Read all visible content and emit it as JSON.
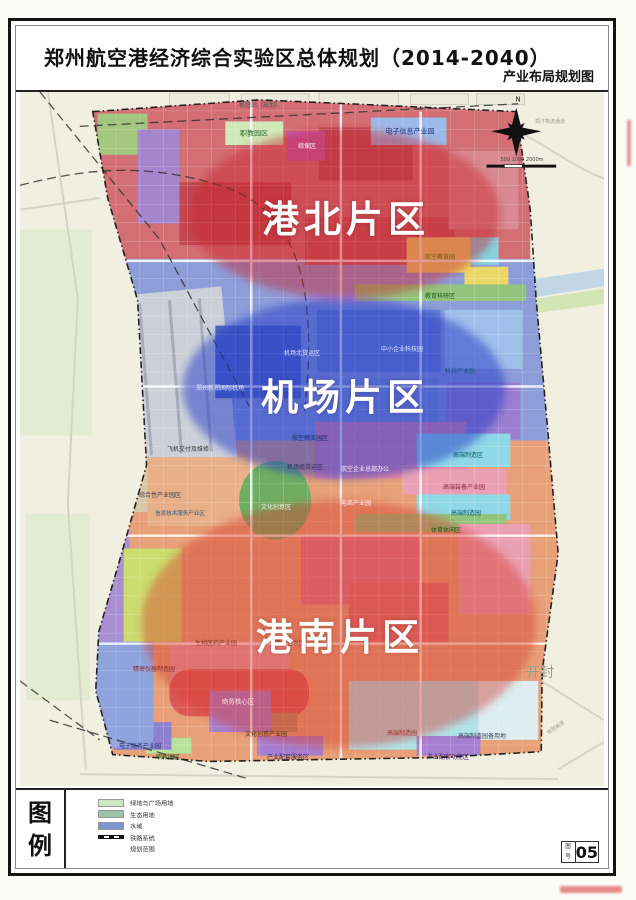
{
  "document": {
    "title": "郑州航空港经济综合实验区总体规划（2014-2040）",
    "subtitle": "产业布局规划图"
  },
  "zones": [
    {
      "label": "港北片区",
      "fill": "rgba(200,30,45,0.46)",
      "cx": 326,
      "cy": 124,
      "rx": 156,
      "ry": 86
    },
    {
      "label": "机场片区",
      "fill": "rgba(38,56,198,0.50)",
      "cx": 325,
      "cy": 302,
      "rx": 162,
      "ry": 92
    },
    {
      "label": "港南片区",
      "fill": "rgba(214,58,48,0.44)",
      "cx": 320,
      "cy": 542,
      "rx": 198,
      "ry": 126
    }
  ],
  "legend": {
    "title_chars": [
      "图",
      "例"
    ],
    "items": [
      {
        "type": "swatch",
        "color": "#cfe4c0",
        "label": "绿地与广场用地"
      },
      {
        "type": "swatch",
        "color": "#9cc4ac",
        "label": "生态用地"
      },
      {
        "type": "swatch",
        "color": "#7e96d0",
        "label": "水域"
      },
      {
        "type": "rail",
        "color": "#111111",
        "label": "铁路系统"
      },
      {
        "type": "boundary",
        "color": "#333333",
        "label": "规划范围"
      }
    ]
  },
  "sheet": {
    "label_chars": [
      "图",
      "号"
    ],
    "number": "05"
  },
  "map_labels": [
    {
      "t": "枢纽站（规划）",
      "x": 240,
      "y": 14,
      "c": "#555555",
      "s": 6
    },
    {
      "t": "职教园区",
      "x": 234,
      "y": 42,
      "c": "#2a6a2a",
      "s": 7
    },
    {
      "t": "综保区",
      "x": 287,
      "y": 55,
      "c": "#ffffff",
      "s": 6
    },
    {
      "t": "电子信息产业园",
      "x": 390,
      "y": 40,
      "c": "#16347e",
      "s": 7
    },
    {
      "t": "郑汴物流通道",
      "x": 530,
      "y": 30,
      "c": "#9a9a90",
      "s": 5
    },
    {
      "t": "N",
      "x": 498,
      "y": 8,
      "c": "#222222",
      "s": 7
    },
    {
      "t": "500 1000 2000m",
      "x": 502,
      "y": 68,
      "c": "#444444",
      "s": 5
    },
    {
      "t": "航空教育园",
      "x": 420,
      "y": 166,
      "c": "#7a5a10",
      "s": 6
    },
    {
      "t": "教育科研区",
      "x": 420,
      "y": 205,
      "c": "#1e5a1e",
      "s": 6
    },
    {
      "t": "机场北货运区",
      "x": 282,
      "y": 262,
      "c": "#dfe8ff",
      "s": 6
    },
    {
      "t": "郑州新郑国际机场",
      "x": 200,
      "y": 297,
      "c": "#e8ecff",
      "s": 6
    },
    {
      "t": "中小企业科技园",
      "x": 382,
      "y": 258,
      "c": "#dbe4ff",
      "s": 6
    },
    {
      "t": "科技产业园",
      "x": 440,
      "y": 280,
      "c": "#175a78",
      "s": 6
    },
    {
      "t": "航空物流园区",
      "x": 290,
      "y": 347,
      "c": "#1a2a6a",
      "s": 6
    },
    {
      "t": "飞机交付及维修",
      "x": 168,
      "y": 358,
      "c": "#333333",
      "s": 6
    },
    {
      "t": "机场南货运区",
      "x": 285,
      "y": 376,
      "c": "#2a3050",
      "s": 6
    },
    {
      "t": "航空企业总部办公",
      "x": 345,
      "y": 378,
      "c": "#fff2f2",
      "s": 6
    },
    {
      "t": "综合性产业园区",
      "x": 140,
      "y": 404,
      "c": "#404050",
      "s": 6
    },
    {
      "t": "信息技术服务产业区",
      "x": 160,
      "y": 422,
      "c": "#2a5a8a",
      "s": 5.5
    },
    {
      "t": "文化创意区",
      "x": 256,
      "y": 416,
      "c": "#eaffea",
      "s": 6
    },
    {
      "t": "电商产业园",
      "x": 336,
      "y": 412,
      "c": "#fff0f4",
      "s": 6
    },
    {
      "t": "高端制造区",
      "x": 448,
      "y": 364,
      "c": "#0a5a6a",
      "s": 6
    },
    {
      "t": "高端装备产业园",
      "x": 444,
      "y": 396,
      "c": "#8a2a4a",
      "s": 6
    },
    {
      "t": "高端制造园",
      "x": 446,
      "y": 422,
      "c": "#0a5a6a",
      "s": 6
    },
    {
      "t": "体育休闲区",
      "x": 426,
      "y": 439,
      "c": "#1a5a1a",
      "s": 6
    },
    {
      "t": "精密仪器制造园",
      "x": 134,
      "y": 578,
      "c": "#8a2a2a",
      "s": 6
    },
    {
      "t": "生物医药产业园",
      "x": 196,
      "y": 552,
      "c": "#8a3a2a",
      "s": 6
    },
    {
      "t": "电子信息园",
      "x": 270,
      "y": 552,
      "c": "#8a3a2a",
      "s": 6
    },
    {
      "t": "商务核心区",
      "x": 218,
      "y": 610,
      "c": "#ffe0e0",
      "s": 6.5
    },
    {
      "t": "文化创意产业园",
      "x": 246,
      "y": 643,
      "c": "#50350f",
      "s": 6
    },
    {
      "t": "电子商务产业园",
      "x": 120,
      "y": 655,
      "c": "#2a2a7a",
      "s": 6
    },
    {
      "t": "职教园区",
      "x": 148,
      "y": 666,
      "c": "#1a5a1a",
      "s": 6
    },
    {
      "t": "产业配套服务区",
      "x": 268,
      "y": 666,
      "c": "#2a2a6a",
      "s": 6
    },
    {
      "t": "高端制造园",
      "x": 382,
      "y": 642,
      "c": "#b03030",
      "s": 6
    },
    {
      "t": "高端制造园备用地",
      "x": 462,
      "y": 645,
      "c": "#40485a",
      "s": 6
    },
    {
      "t": "产业配套功能区",
      "x": 428,
      "y": 666,
      "c": "#3a1a6a",
      "s": 6
    },
    {
      "t": "开封",
      "x": 520,
      "y": 582,
      "c": "#9a9a90",
      "s": 14
    },
    {
      "t": "商登高速",
      "x": 536,
      "y": 636,
      "c": "#a0a096",
      "s": 5,
      "r": -35
    }
  ]
}
